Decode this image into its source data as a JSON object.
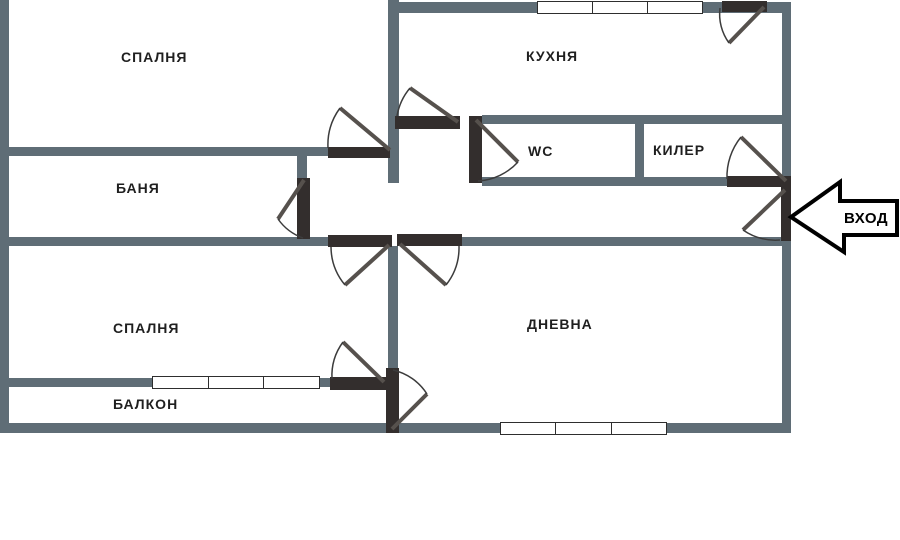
{
  "title": "apartment-floor-plan",
  "rooms": {
    "bedroom_top": {
      "label": "СПАЛНЯ"
    },
    "kitchen": {
      "label": "КУХНЯ"
    },
    "bathroom": {
      "label": "БАНЯ"
    },
    "wc": {
      "label": "WC"
    },
    "pantry": {
      "label": "КИЛЕР"
    },
    "bedroom_bottom": {
      "label": "СПАЛНЯ"
    },
    "balcony": {
      "label": "БАЛКОН"
    },
    "living_room": {
      "label": "ДНЕВНА"
    }
  },
  "entrance": {
    "label": "ВХОД"
  },
  "colors": {
    "wall": "#5f6d76",
    "door_leaf_bar": "#332e2d",
    "swing_line": "#56514d",
    "swing_arc": "#3c3c3c",
    "arrow_outline": "#000000",
    "background": "#ffffff",
    "label_text": "#1f1f1f"
  }
}
